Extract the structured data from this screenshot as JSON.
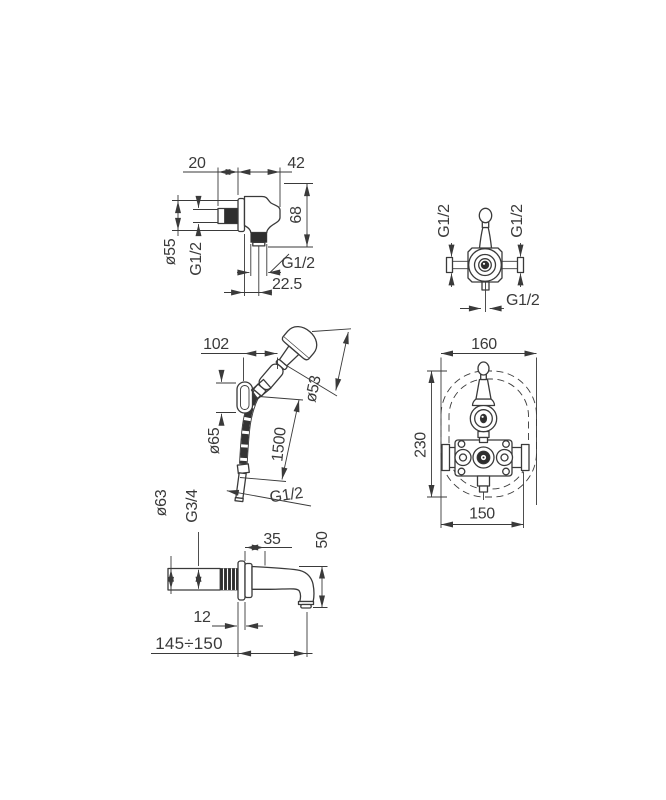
{
  "colors": {
    "background": "#ffffff",
    "line": "#3a3a3a",
    "fill_dark": "#2e2e2e"
  },
  "views": {
    "wall_union": {
      "dim_width_20": "20",
      "dim_depth_42": "42",
      "dim_height_68": "68",
      "dia_flange": "ø55",
      "thread_inlet": "G1/2",
      "thread_outlet": "G1/2",
      "dim_offset_22_5": "22.5"
    },
    "valve_top": {
      "thread_left": "G1/2",
      "thread_right": "G1/2",
      "thread_bottom": "G1/2"
    },
    "hand_shower": {
      "dim_reach_102": "102",
      "dia_head": "ø53",
      "dia_bracket": "ø65",
      "hose_length_1500": "1500",
      "thread_hose": "G1/2"
    },
    "valve_front": {
      "dim_width_160": "160",
      "dim_height_230": "230",
      "dim_width_150": "150"
    },
    "spout": {
      "dia_flange": "ø63",
      "thread": "G3/4",
      "dim_35": "35",
      "dim_50": "50",
      "dim_12": "12",
      "dim_reach": "145÷150"
    }
  }
}
